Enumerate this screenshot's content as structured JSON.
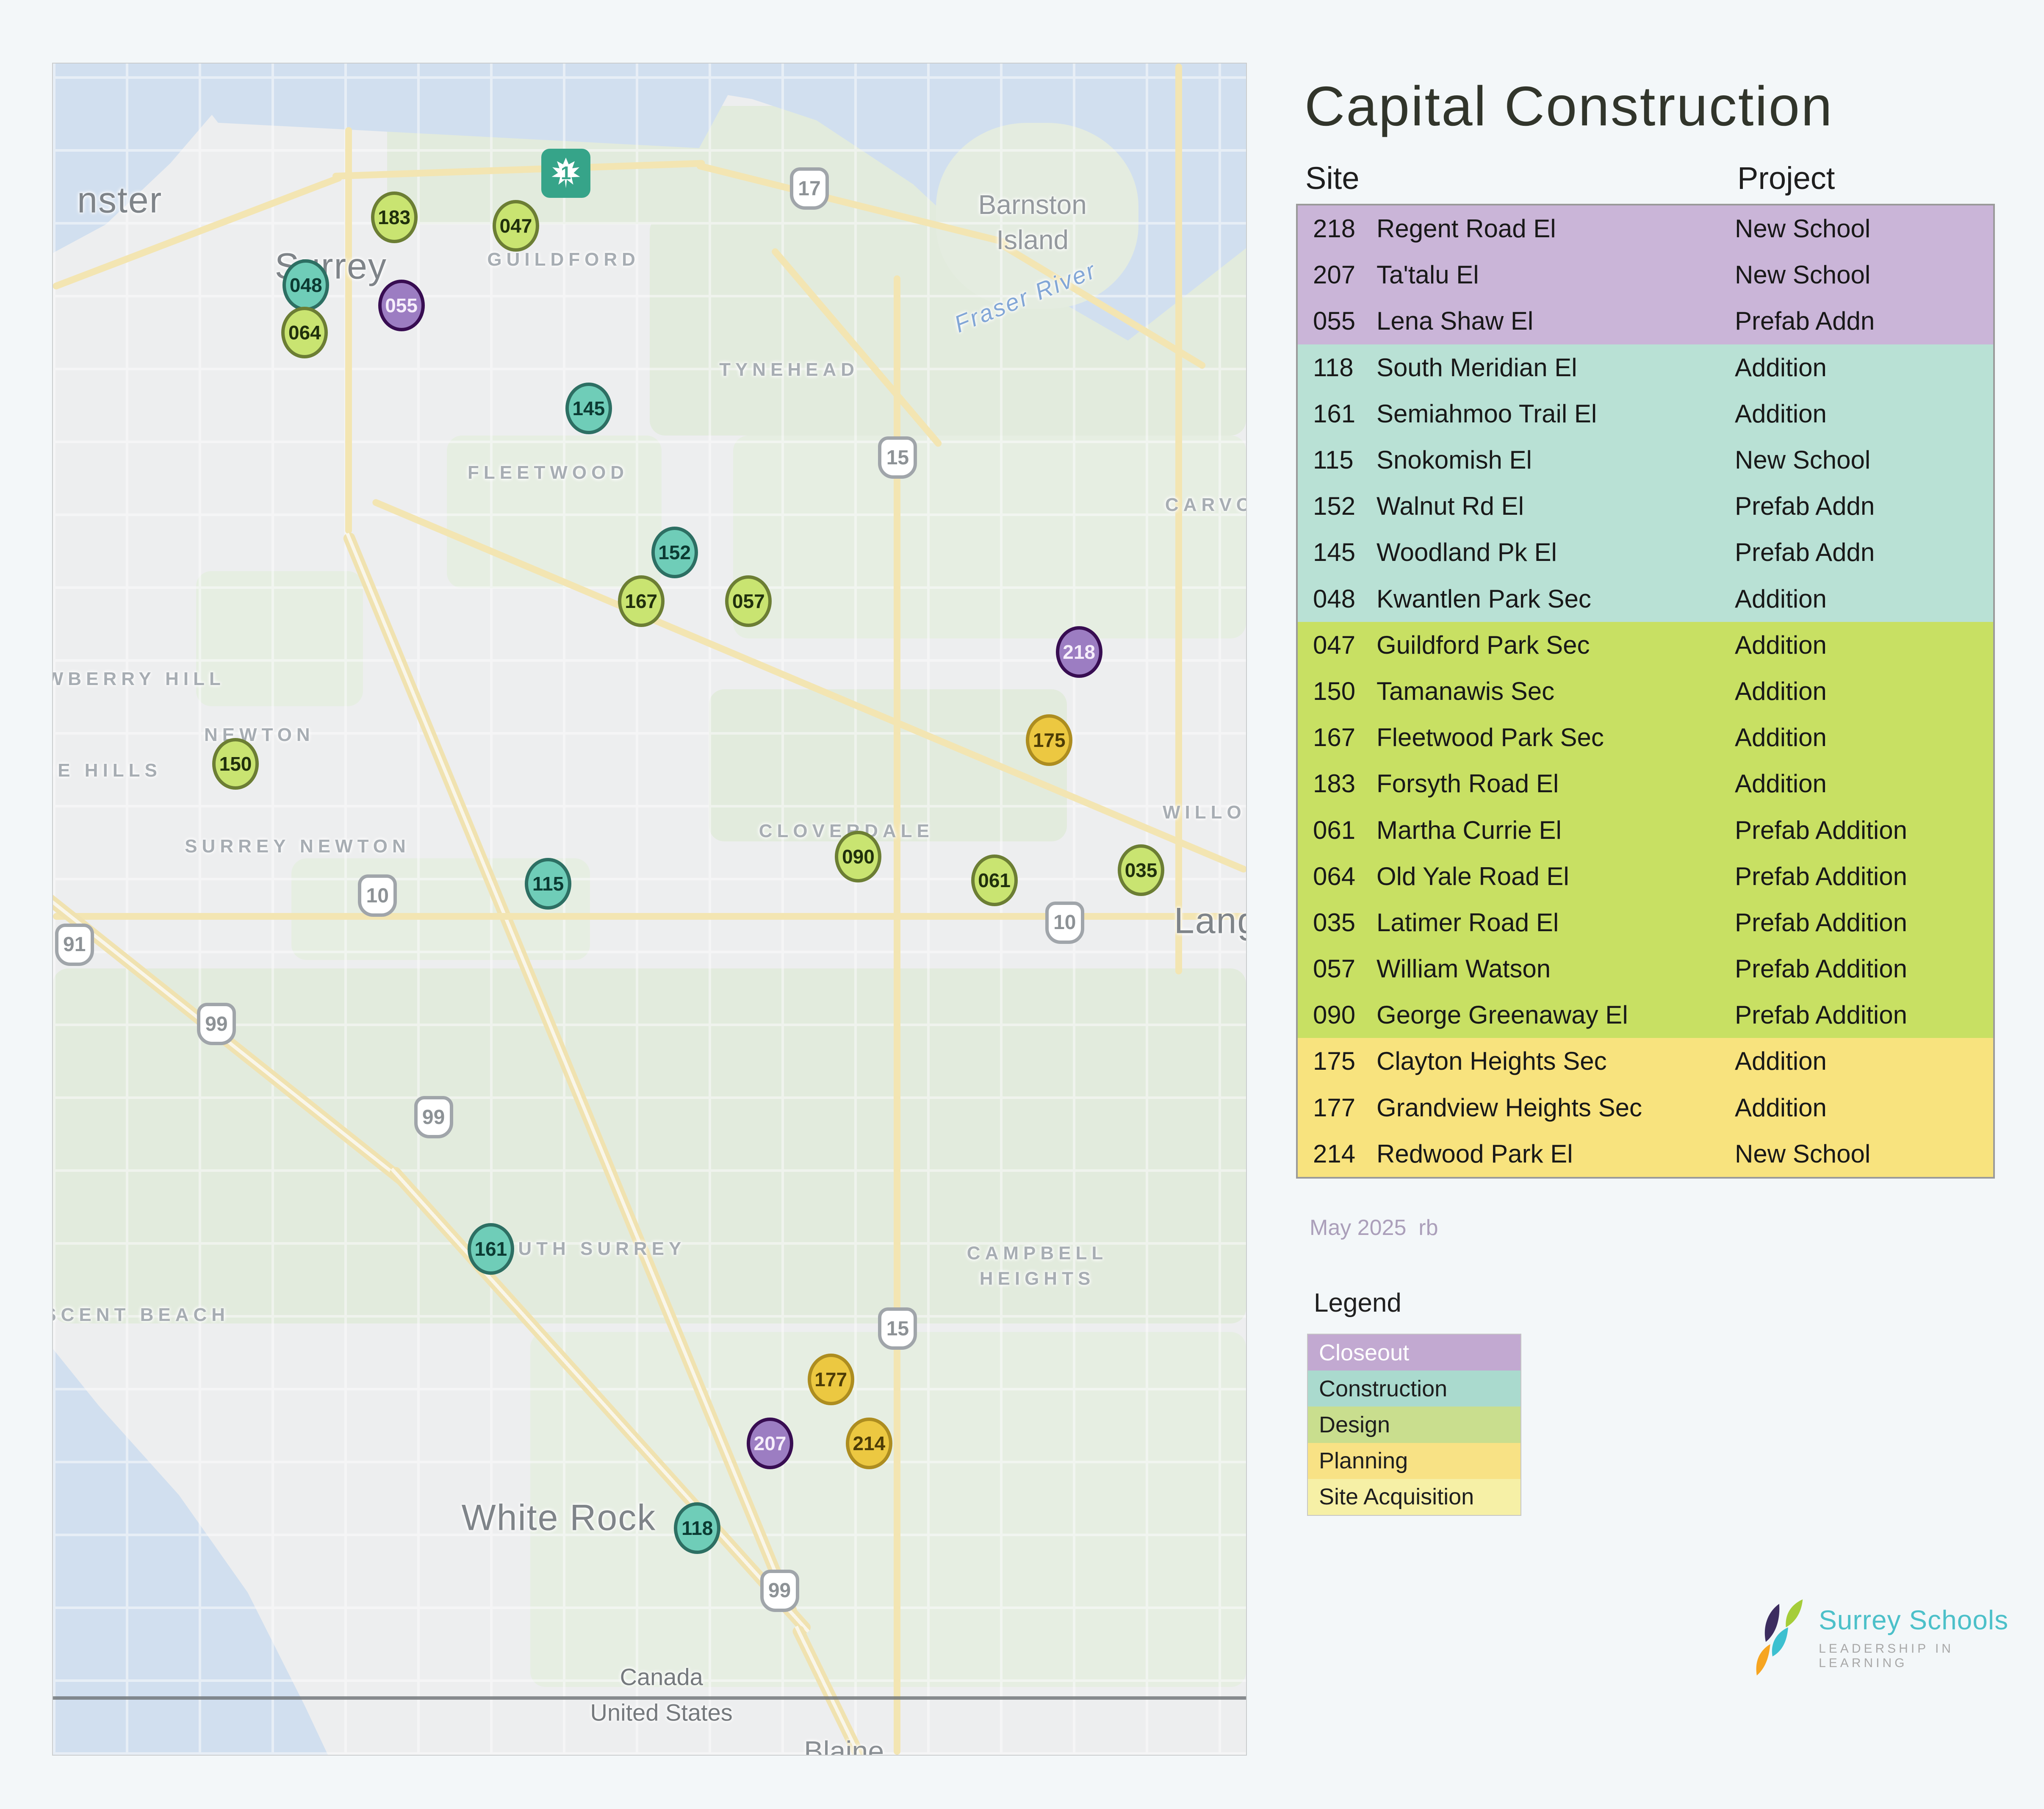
{
  "title": "Capital Construction",
  "table": {
    "col_site": "Site",
    "col_project": "Project",
    "rows": [
      {
        "site": "218",
        "name": "Regent Road El",
        "project": "New School",
        "status": "closeout"
      },
      {
        "site": "207",
        "name": "Ta'talu El",
        "project": "New School",
        "status": "closeout"
      },
      {
        "site": "055",
        "name": "Lena Shaw El",
        "project": "Prefab Addn",
        "status": "closeout"
      },
      {
        "site": "118",
        "name": "South Meridian El",
        "project": "Addition",
        "status": "construction"
      },
      {
        "site": "161",
        "name": "Semiahmoo Trail El",
        "project": "Addition",
        "status": "construction"
      },
      {
        "site": "115",
        "name": "Snokomish El",
        "project": "New School",
        "status": "construction"
      },
      {
        "site": "152",
        "name": "Walnut Rd El",
        "project": "Prefab Addn",
        "status": "construction"
      },
      {
        "site": "145",
        "name": "Woodland Pk El",
        "project": "Prefab Addn",
        "status": "construction"
      },
      {
        "site": "048",
        "name": "Kwantlen Park Sec",
        "project": "Addition",
        "status": "construction"
      },
      {
        "site": "047",
        "name": "Guildford Park Sec",
        "project": "Addition",
        "status": "design"
      },
      {
        "site": "150",
        "name": "Tamanawis Sec",
        "project": "Addition",
        "status": "design"
      },
      {
        "site": "167",
        "name": "Fleetwood Park Sec",
        "project": "Addition",
        "status": "design"
      },
      {
        "site": "183",
        "name": "Forsyth Road El",
        "project": "Addition",
        "status": "design"
      },
      {
        "site": "061",
        "name": "Martha Currie El",
        "project": "Prefab Addition",
        "status": "design"
      },
      {
        "site": "064",
        "name": "Old Yale Road El",
        "project": "Prefab Addition",
        "status": "design"
      },
      {
        "site": "035",
        "name": "Latimer Road El",
        "project": "Prefab Addition",
        "status": "design"
      },
      {
        "site": "057",
        "name": "William Watson",
        "project": "Prefab Addition",
        "status": "design"
      },
      {
        "site": "090",
        "name": "George Greenaway El",
        "project": "Prefab Addition",
        "status": "design"
      },
      {
        "site": "175",
        "name": "Clayton Heights Sec",
        "project": "Addition",
        "status": "planning"
      },
      {
        "site": "177",
        "name": "Grandview Heights Sec",
        "project": "Addition",
        "status": "planning"
      },
      {
        "site": "214",
        "name": "Redwood Park El",
        "project": "New School",
        "status": "planning"
      }
    ]
  },
  "status_colors": {
    "closeout": {
      "block": "#cab5d8",
      "legend": "#c2a9d1",
      "legend_text": "#ffffff",
      "marker_fill": "#9c7dc2",
      "marker_border": "#380d52",
      "marker_text": "#f6eefb"
    },
    "construction": {
      "block": "#b9e1d5",
      "legend": "#aadace",
      "legend_text": "#1e1e1e",
      "marker_fill": "#6fcdb8",
      "marker_border": "#2d6f63",
      "marker_text": "#0c3b33"
    },
    "design": {
      "block": "#c8e063",
      "legend": "#c9de8e",
      "legend_text": "#1e1e1e",
      "marker_fill": "#c9e471",
      "marker_border": "#6c7e34",
      "marker_text": "#20300c"
    },
    "planning": {
      "block": "#f8e37e",
      "legend": "#f8e285",
      "legend_text": "#1e1e1e",
      "marker_fill": "#ecc841",
      "marker_border": "#ad8d20",
      "marker_text": "#4d3c06"
    },
    "site_acquisition": {
      "block": "#f6f0a6",
      "legend": "#f6f0a6",
      "legend_text": "#1e1e1e"
    }
  },
  "footnote": "May 2025  rb",
  "legend": {
    "title": "Legend",
    "items": [
      {
        "label": "Closeout",
        "status": "closeout"
      },
      {
        "label": "Construction",
        "status": "construction"
      },
      {
        "label": "Design",
        "status": "design"
      },
      {
        "label": "Planning",
        "status": "planning"
      },
      {
        "label": "Site Acquisition",
        "status": "site_acquisition"
      }
    ]
  },
  "logo": {
    "name": "Surrey Schools",
    "tagline": "LEADERSHIP IN LEARNING",
    "name_color": "#4cc0c9",
    "icon_colors": {
      "navy": "#3c2d60",
      "lime": "#a5cd39",
      "teal": "#3cc0d0",
      "orange": "#f6a521"
    }
  },
  "map": {
    "highway1_badge": {
      "number": "1"
    },
    "markers": [
      {
        "id": "183",
        "status": "design",
        "x": 28.6,
        "y": 9.1
      },
      {
        "id": "047",
        "status": "design",
        "x": 38.8,
        "y": 9.6
      },
      {
        "id": "048",
        "status": "construction",
        "x": 21.2,
        "y": 13.1
      },
      {
        "id": "055",
        "status": "closeout",
        "x": 29.2,
        "y": 14.3
      },
      {
        "id": "064",
        "status": "design",
        "x": 21.1,
        "y": 15.9
      },
      {
        "id": "145",
        "status": "construction",
        "x": 44.9,
        "y": 20.4
      },
      {
        "id": "152",
        "status": "construction",
        "x": 52.1,
        "y": 28.9
      },
      {
        "id": "167",
        "status": "design",
        "x": 49.3,
        "y": 31.8
      },
      {
        "id": "057",
        "status": "design",
        "x": 58.3,
        "y": 31.8
      },
      {
        "id": "218",
        "status": "closeout",
        "x": 86.0,
        "y": 34.8
      },
      {
        "id": "175",
        "status": "planning",
        "x": 83.5,
        "y": 40.0
      },
      {
        "id": "150",
        "status": "design",
        "x": 15.3,
        "y": 41.4
      },
      {
        "id": "115",
        "status": "construction",
        "x": 41.5,
        "y": 48.5
      },
      {
        "id": "090",
        "status": "design",
        "x": 67.5,
        "y": 46.9
      },
      {
        "id": "061",
        "status": "design",
        "x": 78.9,
        "y": 48.3
      },
      {
        "id": "035",
        "status": "design",
        "x": 91.2,
        "y": 47.7
      },
      {
        "id": "161",
        "status": "construction",
        "x": 36.7,
        "y": 70.1
      },
      {
        "id": "177",
        "status": "planning",
        "x": 65.2,
        "y": 77.8
      },
      {
        "id": "207",
        "status": "closeout",
        "x": 60.1,
        "y": 81.6
      },
      {
        "id": "214",
        "status": "planning",
        "x": 68.4,
        "y": 81.6
      },
      {
        "id": "118",
        "status": "construction",
        "x": 54.0,
        "y": 86.6
      }
    ],
    "labels": [
      {
        "text": "nster",
        "cls": "city-lg",
        "x": 5.6,
        "y": 8.1
      },
      {
        "text": "Surrey",
        "cls": "city-lg",
        "x": 23.3,
        "y": 12.0
      },
      {
        "text": "GUILDFORD",
        "cls": "district",
        "x": 42.8,
        "y": 11.6
      },
      {
        "text": "Barnston Island",
        "cls": "city-md",
        "x": 82.1,
        "y": 9.4
      },
      {
        "text": "Fraser River",
        "cls": "water",
        "x": 81.5,
        "y": 13.8,
        "rot": -22
      },
      {
        "text": "TYNEHEAD",
        "cls": "district",
        "x": 61.7,
        "y": 18.1
      },
      {
        "text": "FLEETWOOD",
        "cls": "district",
        "x": 41.5,
        "y": 24.2
      },
      {
        "text": "CARVO",
        "cls": "district",
        "x": 97.0,
        "y": 26.1
      },
      {
        "text": "AWBERRY HILL",
        "cls": "district",
        "x": 6.2,
        "y": 36.4
      },
      {
        "text": "NEWTON",
        "cls": "district",
        "x": 17.3,
        "y": 39.7
      },
      {
        "text": "NE HILLS",
        "cls": "district",
        "x": 4.0,
        "y": 41.8
      },
      {
        "text": "SURREY NEWTON",
        "cls": "district",
        "x": 20.5,
        "y": 46.3
      },
      {
        "text": "CLOVERDALE",
        "cls": "district",
        "x": 66.5,
        "y": 45.4
      },
      {
        "text": "WILLO",
        "cls": "district",
        "x": 96.5,
        "y": 44.3
      },
      {
        "text": "Lang",
        "cls": "city-lg",
        "x": 97.5,
        "y": 50.7
      },
      {
        "text": "CAMPBELL HEIGHTS",
        "cls": "district wrap",
        "x": 82.5,
        "y": 71.1
      },
      {
        "text": "SOUTH SURREY",
        "cls": "district",
        "x": 44.5,
        "y": 70.1
      },
      {
        "text": "ESCENT BEACH",
        "cls": "district",
        "x": 6.3,
        "y": 74.0
      },
      {
        "text": "White Rock",
        "cls": "city-lg",
        "x": 42.4,
        "y": 86.0
      },
      {
        "text": "Canada",
        "cls": "border",
        "x": 51.0,
        "y": 95.4
      },
      {
        "text": "United States",
        "cls": "border",
        "x": 51.0,
        "y": 97.5
      },
      {
        "text": "Blaine",
        "cls": "city-sm",
        "x": 66.3,
        "y": 99.8
      }
    ],
    "shields": [
      {
        "n": "17",
        "x": 63.4,
        "y": 7.4
      },
      {
        "n": "15",
        "x": 70.8,
        "y": 23.3
      },
      {
        "n": "10",
        "x": 27.2,
        "y": 49.2
      },
      {
        "n": "10",
        "x": 84.8,
        "y": 50.8
      },
      {
        "n": "91",
        "x": 1.8,
        "y": 52.1
      },
      {
        "n": "99",
        "x": 13.7,
        "y": 56.8
      },
      {
        "n": "99",
        "x": 31.9,
        "y": 62.3
      },
      {
        "n": "15",
        "x": 70.8,
        "y": 74.8
      },
      {
        "n": "99",
        "x": 60.9,
        "y": 90.3
      }
    ]
  }
}
